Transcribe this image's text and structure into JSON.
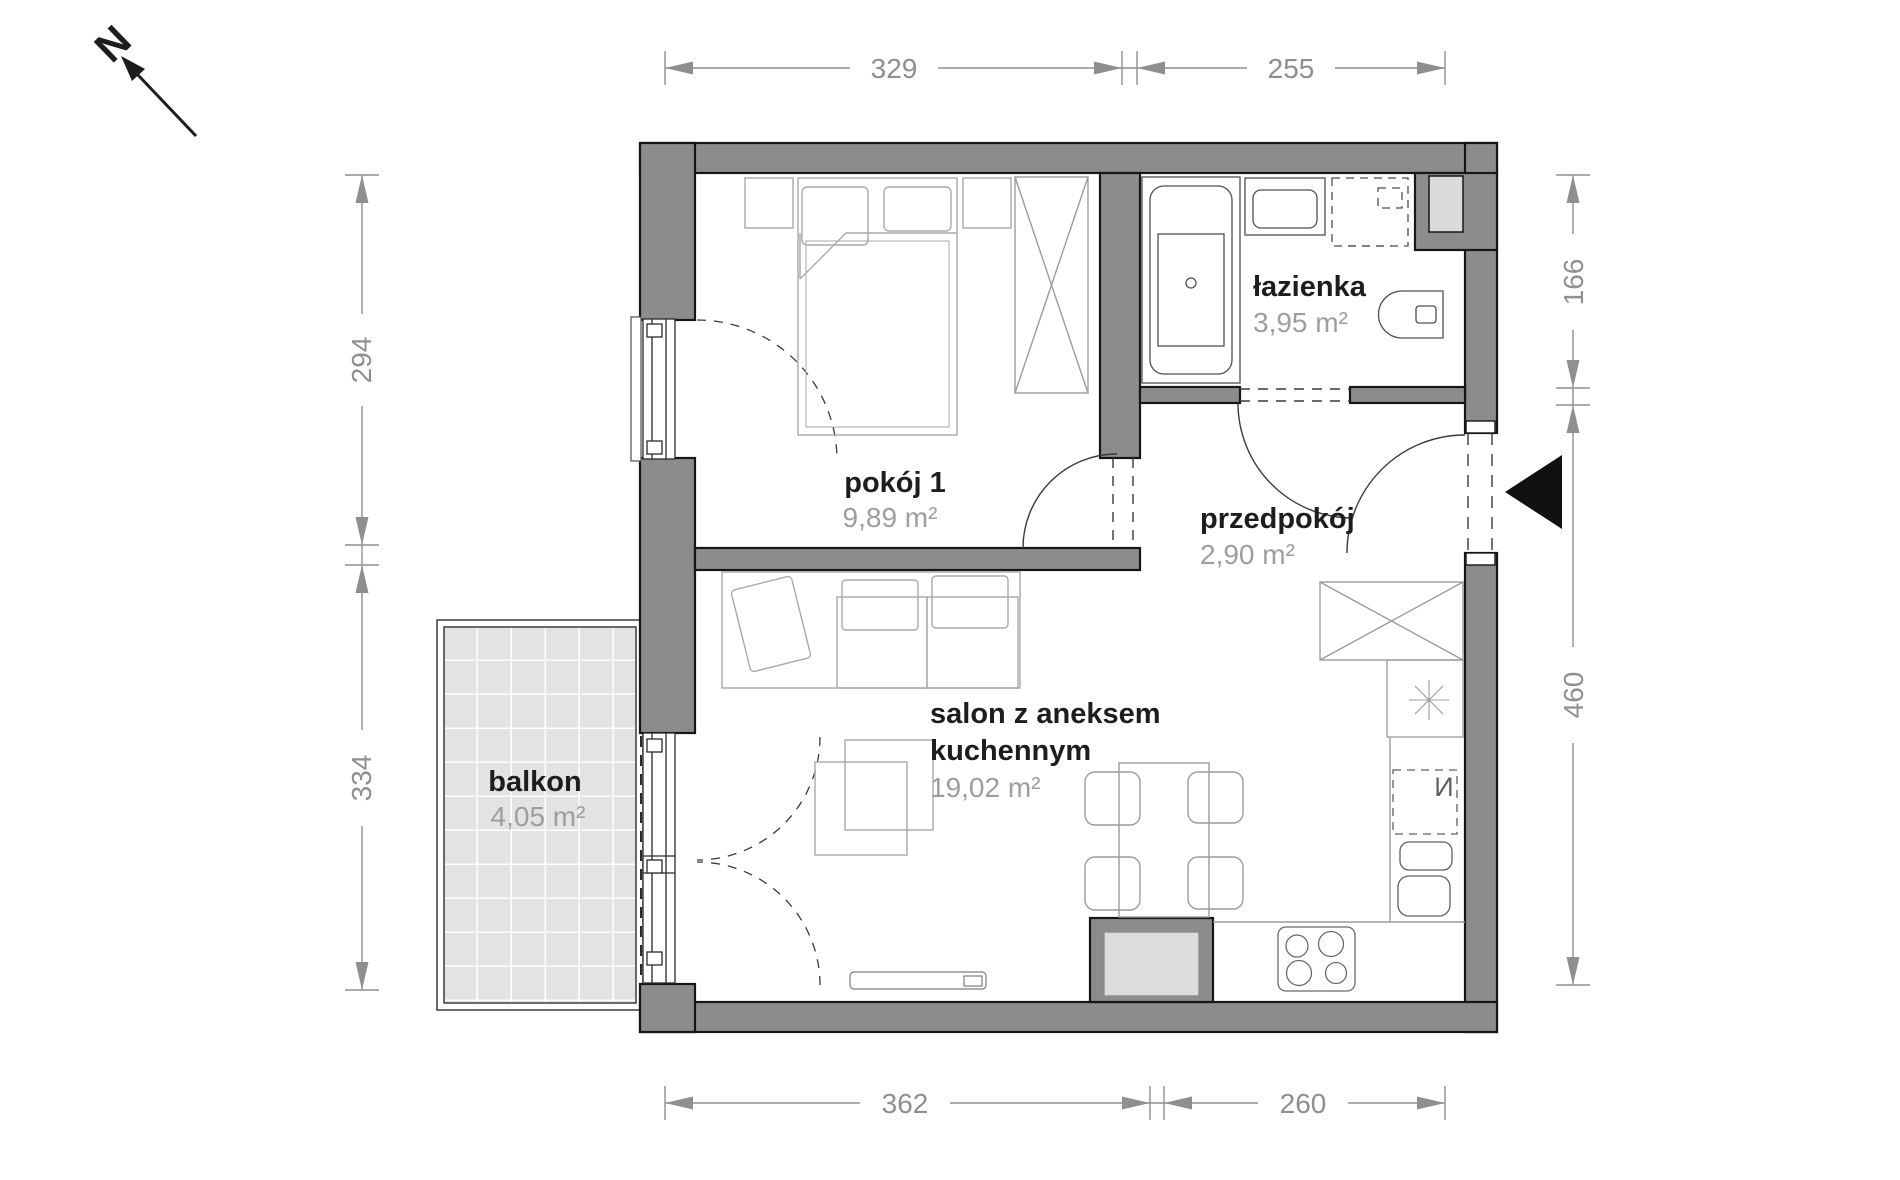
{
  "north": {
    "label": "N"
  },
  "rooms": {
    "pokoj": {
      "name": "pokój 1",
      "area": "9,89 m²"
    },
    "lazienka": {
      "name": "łazienka",
      "area": "3,95 m²"
    },
    "przedpokoj": {
      "name": "przedpokój",
      "area": "2,90 m²"
    },
    "salon": {
      "name_line1": "salon z aneksem",
      "name_line2": "kuchennym",
      "area": "19,02 m²"
    },
    "balkon": {
      "name": "balkon",
      "area": "4,05 m²"
    }
  },
  "dimensions": {
    "top": [
      "329",
      "255"
    ],
    "bottom": [
      "362",
      "260"
    ],
    "left": [
      "294",
      "334"
    ],
    "right": [
      "166",
      "460"
    ]
  },
  "symbols": {
    "dishwasher_label": "И"
  },
  "icons": [
    "north-arrow-icon",
    "entrance-marker-icon",
    "bathtub",
    "washbasin",
    "washing-machine",
    "toilet",
    "bed",
    "wardrobe",
    "sofa",
    "coffee-table",
    "dining-table",
    "dining-chair",
    "tall-cabinet-x",
    "fridge-star",
    "dishwasher",
    "kitchen-sink",
    "stove",
    "radiator",
    "shaft",
    "pier"
  ],
  "colors": {
    "wall_fill": "#8c8c8c",
    "wall_outline": "#161616",
    "dimension": "#8f8f8f",
    "room_name": "#1d1d1d",
    "room_area": "#9e9e9e",
    "balcony_tile": "#e3e3e3",
    "shaft_fill": "#dadada",
    "entrance_marker": "#111111"
  }
}
